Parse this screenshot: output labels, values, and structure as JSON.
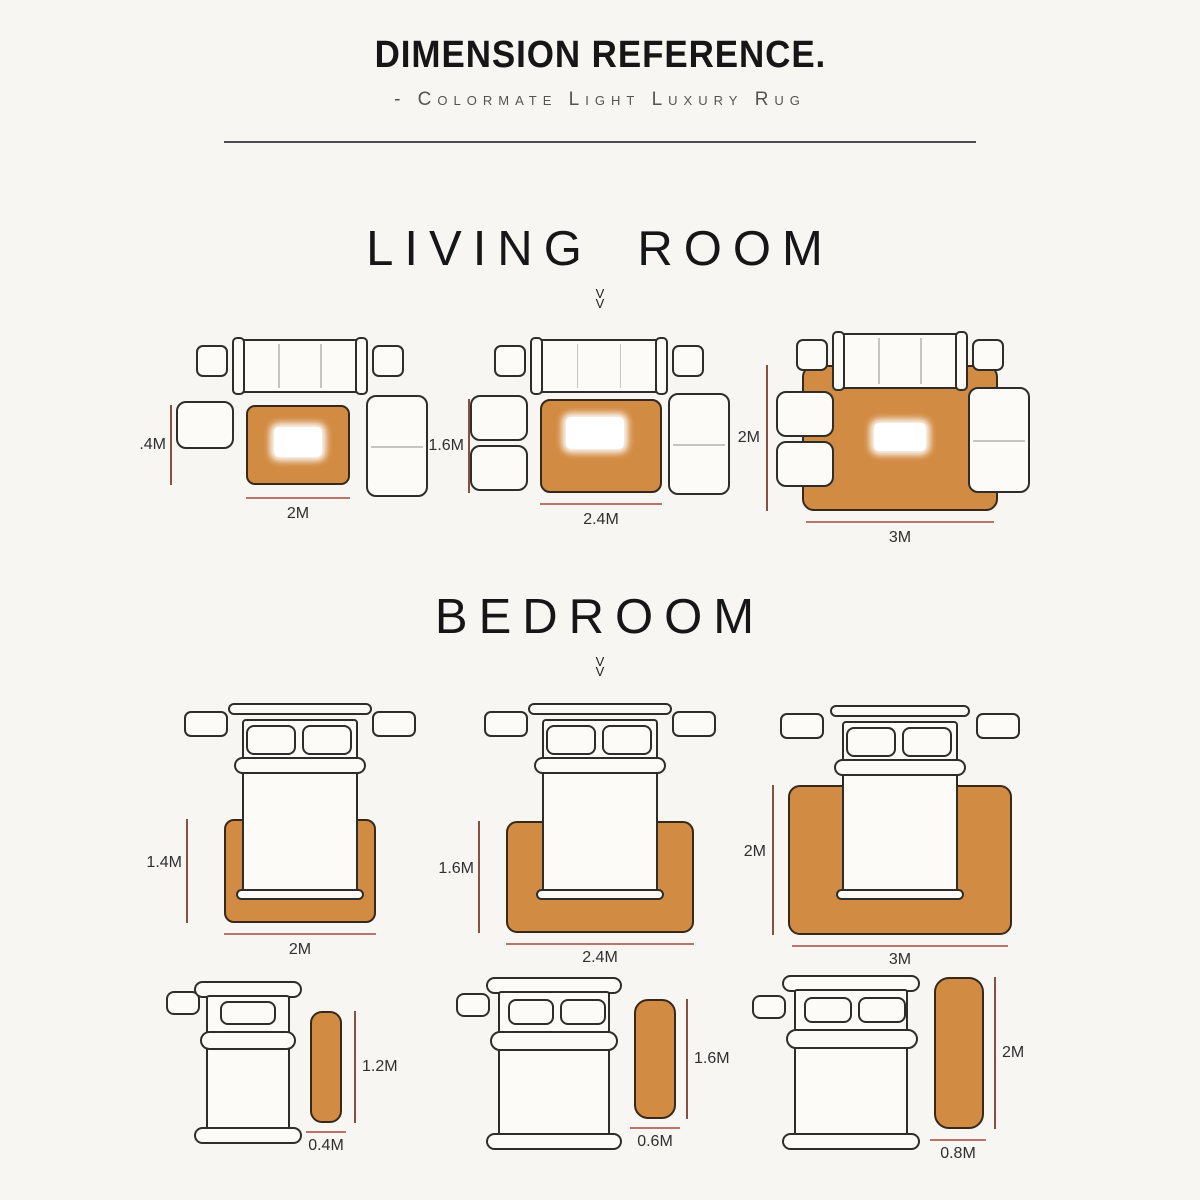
{
  "header": {
    "title": "DIMENSION REFERENCE.",
    "subtitle": "- Colormate Light Luxury Rug"
  },
  "sections": {
    "living": {
      "title": "LIVING ROOM",
      "chevron": "V",
      "layouts": [
        {
          "rug_height": ".4M",
          "rug_width": "2M"
        },
        {
          "rug_height": "1.6M",
          "rug_width": "2.4M"
        },
        {
          "rug_height": "2M",
          "rug_width": "3M"
        }
      ]
    },
    "bedroom": {
      "title": "BEDROOM",
      "chevron": "V",
      "large_rugs": [
        {
          "rug_height": "1.4M",
          "rug_width": "2M"
        },
        {
          "rug_height": "1.6M",
          "rug_width": "2.4M"
        },
        {
          "rug_height": "2M",
          "rug_width": "3M"
        }
      ],
      "runner_rugs": [
        {
          "rug_height": "1.2M",
          "rug_width": "0.4M"
        },
        {
          "rug_height": "1.6M",
          "rug_width": "0.6M"
        },
        {
          "rug_height": "2M",
          "rug_width": "0.8M"
        }
      ]
    }
  },
  "colors": {
    "background": "#f7f6f2",
    "rug_fill": "#d28b42",
    "rug_outline": "#36291b",
    "furniture_outline": "#2d2d2b",
    "dimension_line_vertical": "#8a4f3d",
    "dimension_line_horizontal": "#b9756a",
    "label_color": "#2f2f2f",
    "heading_color": "#161616"
  }
}
